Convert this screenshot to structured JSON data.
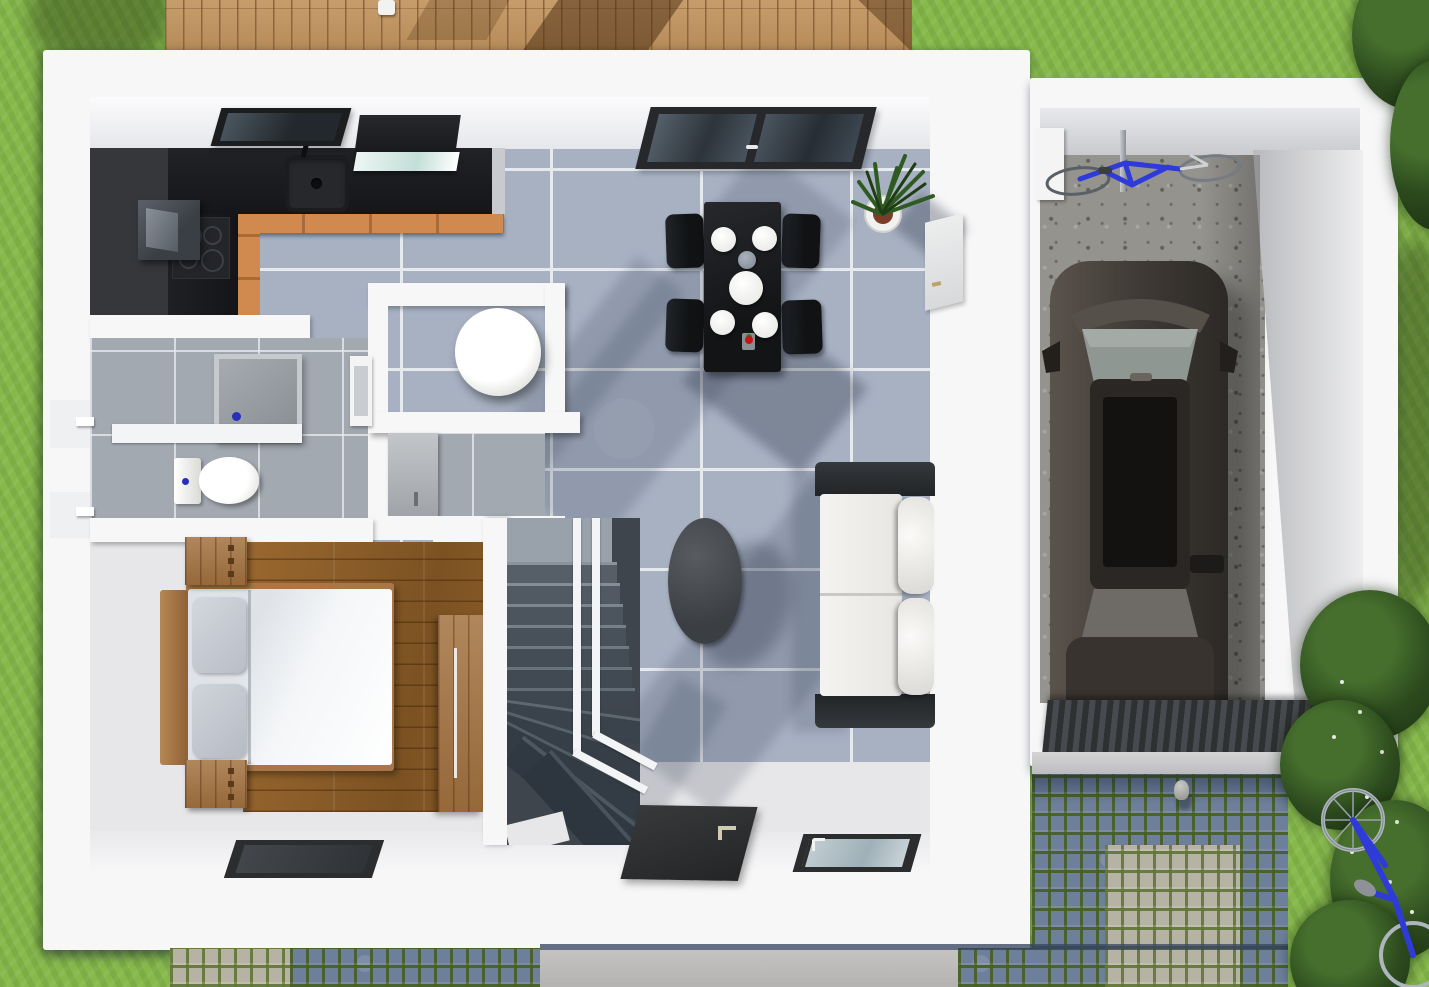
{
  "scene": {
    "kind": "3d-floorplan-render",
    "view": "top-down",
    "width": 1429,
    "height": 987,
    "rooms": [
      {
        "id": "kitchen",
        "features": [
          "l-shaped-black-counter",
          "sink",
          "cooktop",
          "oven",
          "hood",
          "wall-window"
        ]
      },
      {
        "id": "dining",
        "features": [
          "black-table",
          "4-chairs",
          "4-plates",
          "center-bowl",
          "cup",
          "potted-plant",
          "glass-door"
        ]
      },
      {
        "id": "living",
        "features": [
          "white-sofa",
          "oval-coffee-table",
          "entry-door",
          "window"
        ]
      },
      {
        "id": "bathroom",
        "features": [
          "shower",
          "toilet",
          "washbasin"
        ]
      },
      {
        "id": "wc",
        "features": [
          "round-basin-column"
        ]
      },
      {
        "id": "laundry",
        "features": [
          "washer"
        ]
      },
      {
        "id": "bedroom",
        "features": [
          "double-bed",
          "2-nightstands",
          "wardrobe",
          "wood-floor",
          "window"
        ]
      },
      {
        "id": "stairs",
        "features": [
          "winder-staircase",
          "white-railing"
        ]
      }
    ],
    "garage": {
      "features": [
        "car",
        "bicycle",
        "concrete-floor",
        "drain-grate",
        "side-door"
      ]
    },
    "exterior": {
      "features": [
        "lawn",
        "wooden-deck",
        "cobblestone-driveway",
        "concrete-path",
        "bicycle",
        "bushes",
        "bollard"
      ]
    }
  },
  "palette": {
    "grass": "#87b84c",
    "deckGap": "#8a6640",
    "wall": "#f7f7f8",
    "tileBlue": "#a7b1c2",
    "grout": "#e6e9ee",
    "counter": "#1b1d20",
    "cabinet": "#d08a4f",
    "stairTread": "#4c545d",
    "sofaDark": "#2d3033",
    "tableBlack": "#1d1f22",
    "carBody": "#453f3a",
    "cobbleBlue": "#6d7f9b",
    "bikeBlue": "#2f3bd8",
    "doorDark": "#2c2e30"
  }
}
